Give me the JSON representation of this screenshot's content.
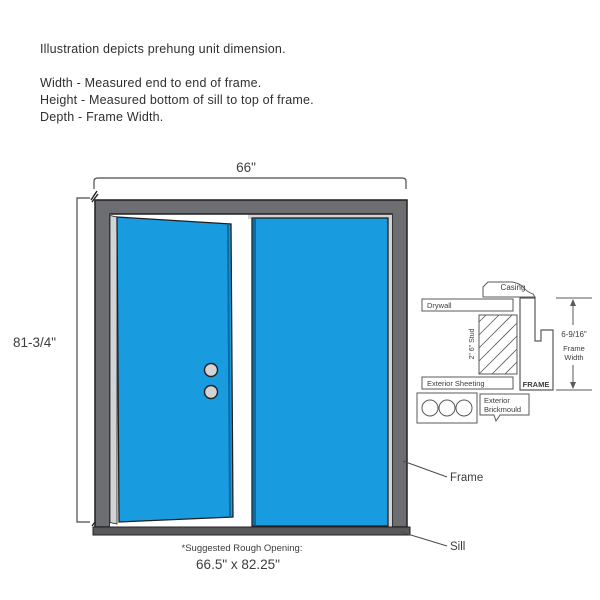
{
  "intro": {
    "title": "Illustration depicts prehung unit dimension.",
    "lines": [
      "Width - Measured end to end of frame.",
      "Height - Measured bottom of sill to top of frame.",
      "Depth - Frame Width."
    ]
  },
  "door_unit": {
    "width_dim": "66\"",
    "height_dim": "81-3/4\"",
    "frame_label": "Frame",
    "sill_label": "Sill",
    "rough_opening_label": "*Suggested Rough Opening:",
    "rough_opening_value": "66.5\" x 82.25\""
  },
  "cross_section": {
    "casing": "Casing",
    "drywall": "Drywall",
    "stud": "2\" 6\" Stud",
    "exterior_sheeting": "Exterior Sheeting",
    "frame": "FRAME",
    "frame_width_value": "6-9/16\"",
    "frame_width_line1": "Frame",
    "frame_width_line2": "Width",
    "brickmould_line1": "Exterior",
    "brickmould_line2": "Brickmould"
  },
  "colors": {
    "door_blue": "#189CDF",
    "door_edge_blue": "#0B6AA2",
    "frame_gray": "#6D6E71",
    "sill_gray": "#58595B",
    "trim_light_gray": "#D1D3D4",
    "line_dark": "#231F20"
  }
}
